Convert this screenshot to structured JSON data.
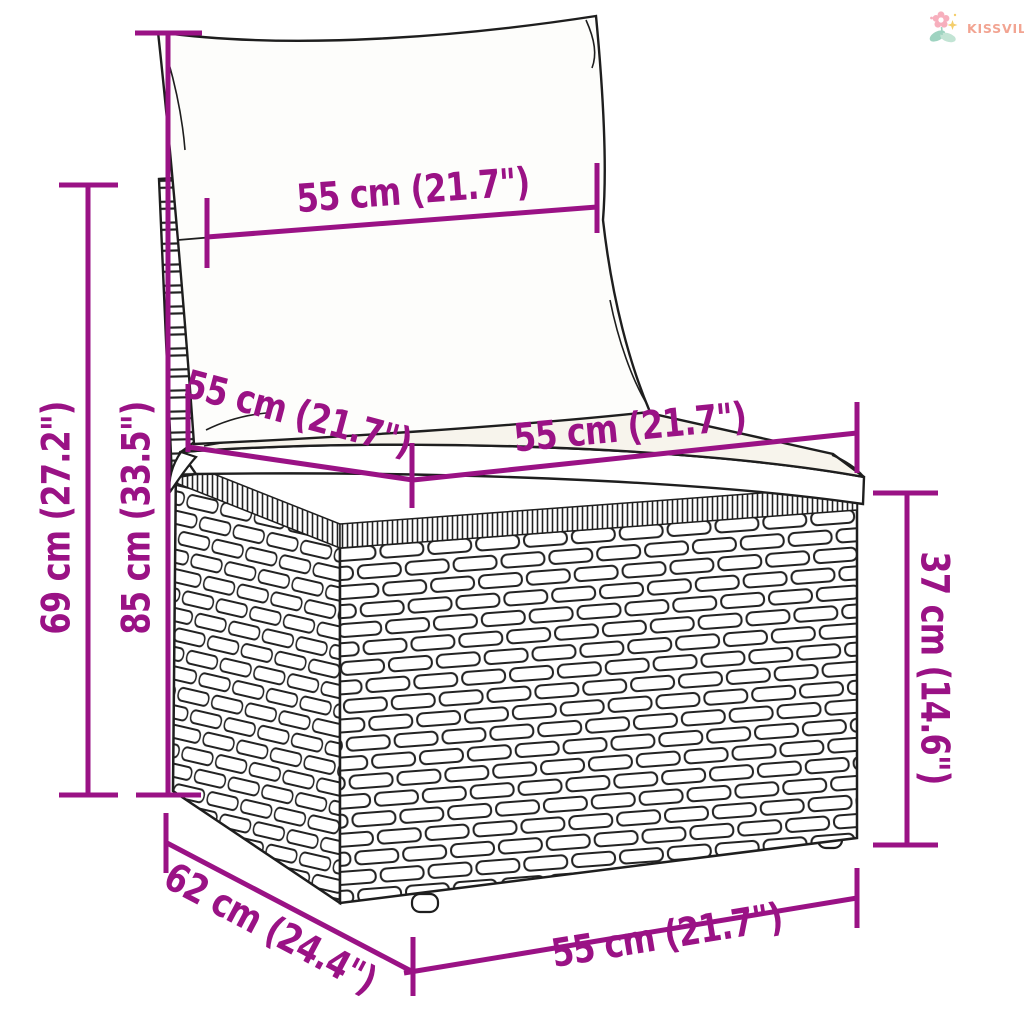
{
  "page": {
    "background": "#ffffff"
  },
  "brand": {
    "name": "KISSVILÁG",
    "text_color": "#f2a492",
    "flower_pink": "#f7afbd",
    "leaf_teal": "#9ed3c0",
    "leaf_teal_light": "#c2e4d4",
    "sparkle_yellow": "#f4ce6b"
  },
  "diagram": {
    "subject": "rattan garden sofa section with cushions - dimension drawing",
    "dimension_color": "#9a1285",
    "outline_color": "#1e1e1e",
    "dimensions": [
      {
        "id": "back-width",
        "label": "55 cm (21.7\")",
        "cm": 55,
        "inches": 21.7
      },
      {
        "id": "backrest-height",
        "label": "69 cm (27.2\")",
        "cm": 69,
        "inches": 27.2
      },
      {
        "id": "total-height",
        "label": "85 cm (33.5\")",
        "cm": 85,
        "inches": 33.5
      },
      {
        "id": "seat-depth",
        "label": "55 cm (21.7\")",
        "cm": 55,
        "inches": 21.7
      },
      {
        "id": "seat-width",
        "label": "55 cm (21.7\")",
        "cm": 55,
        "inches": 21.7
      },
      {
        "id": "seat-height",
        "label": "37 cm (14.6\")",
        "cm": 37,
        "inches": 14.6
      },
      {
        "id": "base-depth",
        "label": "62 cm (24.4\")",
        "cm": 62,
        "inches": 24.4
      },
      {
        "id": "base-width",
        "label": "55 cm (21.7\")",
        "cm": 55,
        "inches": 21.7
      }
    ]
  }
}
